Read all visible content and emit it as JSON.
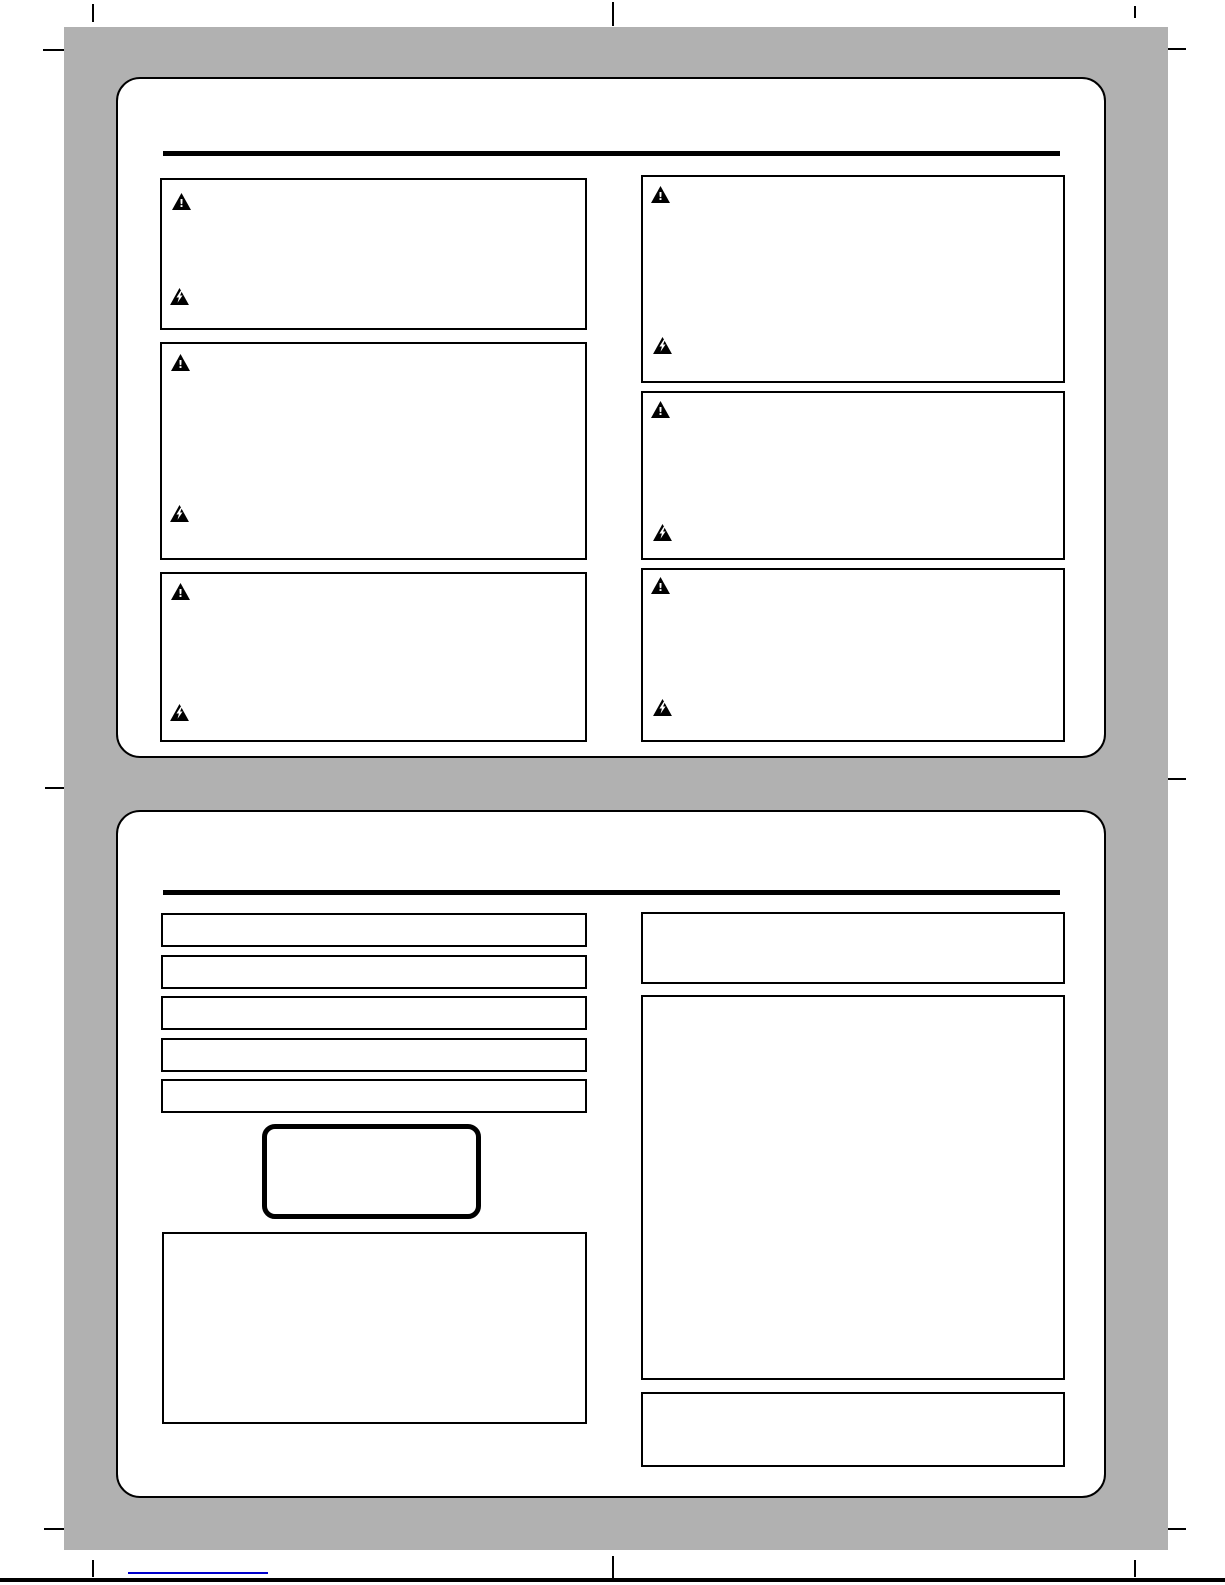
{
  "page": {
    "kind": "scanned-manual-safety-page",
    "background_color": "#ffffff",
    "sheet_color": "#b1b1b1",
    "line_color": "#000000"
  },
  "icons": {
    "warning": {
      "label": "warning-triangle",
      "glyph": "!"
    },
    "electrical": {
      "label": "electric-shock-triangle",
      "glyph": "⚡"
    }
  },
  "top_section": {
    "warning_box_count": 6,
    "boxes_per_column": 3
  },
  "bottom_section": {
    "entry_row_count": 5,
    "right_box_count": 3,
    "has_badge": true
  },
  "footer": {
    "link_color": "#0000cc",
    "link_text": ""
  }
}
